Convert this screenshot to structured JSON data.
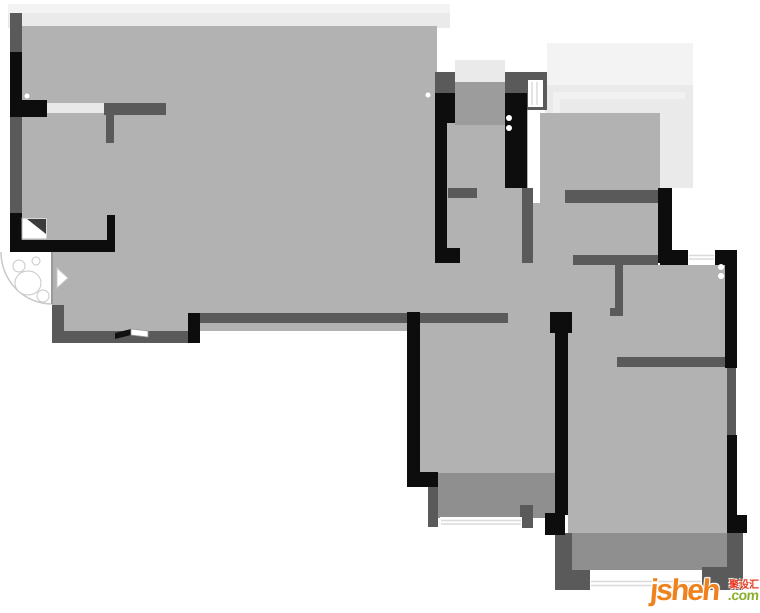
{
  "watermark": {
    "brand": "jsheh",
    "tld": ".com",
    "cn": "聚设汇",
    "brand_color": "#f0821e",
    "tld_color": "#8aaf2b",
    "cn_color": "#e8381d"
  },
  "floorplan": {
    "canvas": {
      "w": 760,
      "h": 613
    },
    "palette": {
      "room_floor": "#b2b2b2",
      "balcony_floor": "#8f8f8f",
      "entry_area": "#9c9c9c",
      "wall_gray": "#5a5a5a",
      "wall_black": "#0d0d0d",
      "glass_light": "#f3f3f3",
      "glass": "#eaeaea",
      "door_opening": "#e9e9e9",
      "window_white": "#ffffff"
    },
    "shapes": [
      {
        "t": "rect",
        "x": 8,
        "y": 4,
        "width": 442,
        "height": 9,
        "fill": "#f3f3f3",
        "name": "top-bay-window-outer"
      },
      {
        "t": "rect",
        "x": 8,
        "y": 13,
        "width": 442,
        "height": 15,
        "fill": "#eaeaea",
        "name": "top-bay-window-inner"
      },
      {
        "t": "rect",
        "x": 547,
        "y": 43,
        "width": 146,
        "height": 44,
        "fill": "#f3f3f3",
        "name": "right-balcony-outer"
      },
      {
        "t": "rect",
        "x": 545,
        "y": 85,
        "width": 148,
        "height": 103,
        "fill": "#eaeaea",
        "name": "right-balcony-glass"
      },
      {
        "t": "rect",
        "x": 553,
        "y": 92,
        "width": 132,
        "height": 90,
        "fill": "#f1f1f1",
        "name": "right-balcony-frame"
      },
      {
        "t": "rect",
        "x": 560,
        "y": 99,
        "width": 125,
        "height": 83,
        "fill": "#eaeaea",
        "name": "right-balcony-frame-2"
      },
      {
        "t": "rect",
        "x": 455,
        "y": 60,
        "width": 50,
        "height": 22,
        "fill": "#eaeaea",
        "name": "entry-porch-glass"
      },
      {
        "t": "rect",
        "x": 22,
        "y": 26,
        "width": 415,
        "height": 305,
        "fill": "#b2b2b2",
        "name": "living-room-floor"
      },
      {
        "t": "rect",
        "x": 437,
        "y": 93,
        "width": 91,
        "height": 220,
        "fill": "#b2b2b2",
        "name": "hallway-floor"
      },
      {
        "t": "rect",
        "x": 540,
        "y": 113,
        "width": 120,
        "height": 150,
        "fill": "#b2b2b2",
        "name": "kitchen-floor"
      },
      {
        "t": "rect",
        "x": 528,
        "y": 203,
        "width": 92,
        "height": 110,
        "fill": "#b2b2b2",
        "name": "corridor-floor"
      },
      {
        "t": "rect",
        "x": 568,
        "y": 265,
        "width": 159,
        "height": 95,
        "fill": "#b2b2b2",
        "name": "bedroom-2-floor"
      },
      {
        "t": "rect",
        "x": 420,
        "y": 313,
        "width": 135,
        "height": 162,
        "fill": "#b2b2b2",
        "name": "bedroom-1-floor"
      },
      {
        "t": "rect",
        "x": 568,
        "y": 360,
        "width": 159,
        "height": 173,
        "fill": "#b2b2b2",
        "name": "master-bedroom-floor"
      },
      {
        "t": "rect",
        "x": 438,
        "y": 473,
        "width": 117,
        "height": 45,
        "fill": "#8f8f8f",
        "name": "balcony-1-floor"
      },
      {
        "t": "rect",
        "x": 558,
        "y": 533,
        "width": 169,
        "height": 37,
        "fill": "#8f8f8f",
        "name": "balcony-2-floor"
      },
      {
        "t": "rect",
        "x": 0,
        "y": 252,
        "width": 52,
        "height": 91,
        "fill": "#ffffff",
        "name": "entry-recess"
      },
      {
        "t": "rect",
        "x": 455,
        "y": 82,
        "width": 50,
        "height": 43,
        "fill": "#9c9c9c",
        "name": "entry-door-area"
      },
      {
        "t": "rect",
        "x": 10,
        "y": 13,
        "width": 12,
        "height": 39,
        "fill": "#5a5a5a",
        "name": "wall-segment"
      },
      {
        "t": "rect",
        "x": 10,
        "y": 117,
        "width": 12,
        "height": 96,
        "fill": "#5a5a5a",
        "name": "wall-segment"
      },
      {
        "t": "rect",
        "x": 104,
        "y": 103,
        "width": 62,
        "height": 12,
        "fill": "#5a5a5a",
        "name": "wall-segment"
      },
      {
        "t": "rect",
        "x": 106,
        "y": 115,
        "width": 8,
        "height": 28,
        "fill": "#5a5a5a",
        "name": "wall-segment"
      },
      {
        "t": "rect",
        "x": 52,
        "y": 305,
        "width": 12,
        "height": 38,
        "fill": "#5a5a5a",
        "name": "wall-segment"
      },
      {
        "t": "rect",
        "x": 52,
        "y": 331,
        "width": 136,
        "height": 12,
        "fill": "#5a5a5a",
        "name": "wall-segment"
      },
      {
        "t": "rect",
        "x": 200,
        "y": 313,
        "width": 308,
        "height": 10,
        "fill": "#5a5a5a",
        "name": "wall-segment"
      },
      {
        "t": "rect",
        "x": 435,
        "y": 72,
        "width": 20,
        "height": 21,
        "fill": "#5a5a5a",
        "name": "wall-segment"
      },
      {
        "t": "rect",
        "x": 448,
        "y": 188,
        "width": 29,
        "height": 10,
        "fill": "#5a5a5a",
        "name": "wall-segment"
      },
      {
        "t": "rect",
        "x": 505,
        "y": 72,
        "width": 42,
        "height": 38,
        "fill": "#5a5a5a",
        "name": "wall-segment"
      },
      {
        "t": "rect",
        "x": 522,
        "y": 188,
        "width": 11,
        "height": 75,
        "fill": "#5a5a5a",
        "name": "wall-segment"
      },
      {
        "t": "rect",
        "x": 565,
        "y": 190,
        "width": 93,
        "height": 13,
        "fill": "#5a5a5a",
        "name": "wall-segment"
      },
      {
        "t": "rect",
        "x": 573,
        "y": 255,
        "width": 85,
        "height": 10,
        "fill": "#5a5a5a",
        "name": "wall-segment"
      },
      {
        "t": "rect",
        "x": 615,
        "y": 263,
        "width": 8,
        "height": 50,
        "fill": "#5a5a5a",
        "name": "wall-segment"
      },
      {
        "t": "rect",
        "x": 610,
        "y": 308,
        "width": 13,
        "height": 8,
        "fill": "#5a5a5a",
        "name": "wall-segment"
      },
      {
        "t": "rect",
        "x": 617,
        "y": 357,
        "width": 110,
        "height": 10,
        "fill": "#5a5a5a",
        "name": "wall-segment"
      },
      {
        "t": "rect",
        "x": 727,
        "y": 360,
        "width": 9,
        "height": 78,
        "fill": "#5a5a5a",
        "name": "wall-segment"
      },
      {
        "t": "rect",
        "x": 727,
        "y": 533,
        "width": 16,
        "height": 54,
        "fill": "#5a5a5a",
        "name": "wall-segment"
      },
      {
        "t": "rect",
        "x": 702,
        "y": 567,
        "width": 41,
        "height": 23,
        "fill": "#5a5a5a",
        "name": "wall-segment"
      },
      {
        "t": "rect",
        "x": 558,
        "y": 570,
        "width": 32,
        "height": 20,
        "fill": "#5a5a5a",
        "name": "wall-segment"
      },
      {
        "t": "rect",
        "x": 555,
        "y": 533,
        "width": 17,
        "height": 57,
        "fill": "#5a5a5a",
        "name": "wall-segment"
      },
      {
        "t": "rect",
        "x": 428,
        "y": 487,
        "width": 10,
        "height": 40,
        "fill": "#5a5a5a",
        "name": "wall-segment"
      },
      {
        "t": "rect",
        "x": 520,
        "y": 505,
        "width": 13,
        "height": 23,
        "fill": "#5a5a5a",
        "name": "wall-segment"
      },
      {
        "t": "rect",
        "x": 10,
        "y": 52,
        "width": 12,
        "height": 65,
        "fill": "#0d0d0d",
        "name": "wall-segment-black"
      },
      {
        "t": "rect",
        "x": 10,
        "y": 213,
        "width": 12,
        "height": 39,
        "fill": "#0d0d0d",
        "name": "wall-segment-black"
      },
      {
        "t": "rect",
        "x": 10,
        "y": 240,
        "width": 102,
        "height": 12,
        "fill": "#0d0d0d",
        "name": "wall-segment-black"
      },
      {
        "t": "rect",
        "x": 10,
        "y": 100,
        "width": 37,
        "height": 17,
        "fill": "#0d0d0d",
        "name": "wall-segment-black"
      },
      {
        "t": "rect",
        "x": 107,
        "y": 215,
        "width": 8,
        "height": 37,
        "fill": "#0d0d0d",
        "name": "wall-segment-black"
      },
      {
        "t": "rect",
        "x": 188,
        "y": 313,
        "width": 12,
        "height": 30,
        "fill": "#0d0d0d",
        "name": "wall-segment-black"
      },
      {
        "t": "rect",
        "x": 435,
        "y": 93,
        "width": 20,
        "height": 30,
        "fill": "#0d0d0d",
        "name": "wall-segment-black"
      },
      {
        "t": "rect",
        "x": 435,
        "y": 123,
        "width": 12,
        "height": 140,
        "fill": "#0d0d0d",
        "name": "wall-segment-black"
      },
      {
        "t": "rect",
        "x": 435,
        "y": 248,
        "width": 25,
        "height": 15,
        "fill": "#0d0d0d",
        "name": "wall-segment-black"
      },
      {
        "t": "rect",
        "x": 505,
        "y": 93,
        "width": 22,
        "height": 95,
        "fill": "#0d0d0d",
        "name": "wall-segment-black"
      },
      {
        "t": "rect",
        "x": 658,
        "y": 188,
        "width": 14,
        "height": 75,
        "fill": "#0d0d0d",
        "name": "wall-segment-black"
      },
      {
        "t": "rect",
        "x": 660,
        "y": 250,
        "width": 28,
        "height": 15,
        "fill": "#0d0d0d",
        "name": "wall-segment-black"
      },
      {
        "t": "rect",
        "x": 715,
        "y": 250,
        "width": 22,
        "height": 15,
        "fill": "#0d0d0d",
        "name": "wall-segment-black"
      },
      {
        "t": "rect",
        "x": 725,
        "y": 250,
        "width": 12,
        "height": 118,
        "fill": "#0d0d0d",
        "name": "wall-segment-black"
      },
      {
        "t": "rect",
        "x": 727,
        "y": 435,
        "width": 10,
        "height": 98,
        "fill": "#0d0d0d",
        "name": "wall-segment-black"
      },
      {
        "t": "rect",
        "x": 737,
        "y": 515,
        "width": 10,
        "height": 18,
        "fill": "#0d0d0d",
        "name": "wall-segment-black"
      },
      {
        "t": "rect",
        "x": 407,
        "y": 312,
        "width": 13,
        "height": 160,
        "fill": "#0d0d0d",
        "name": "wall-segment-black"
      },
      {
        "t": "rect",
        "x": 407,
        "y": 472,
        "width": 31,
        "height": 15,
        "fill": "#0d0d0d",
        "name": "wall-segment-black"
      },
      {
        "t": "rect",
        "x": 550,
        "y": 312,
        "width": 22,
        "height": 21,
        "fill": "#0d0d0d",
        "name": "wall-segment-black"
      },
      {
        "t": "rect",
        "x": 555,
        "y": 333,
        "width": 13,
        "height": 182,
        "fill": "#0d0d0d",
        "name": "wall-segment-black"
      },
      {
        "t": "rect",
        "x": 545,
        "y": 513,
        "width": 20,
        "height": 22,
        "fill": "#0d0d0d",
        "name": "wall-segment-black"
      },
      {
        "t": "rect",
        "x": 47,
        "y": 103,
        "width": 57,
        "height": 10,
        "fill": "#e9e9e9",
        "name": "door-opening"
      },
      {
        "t": "rect",
        "x": 528,
        "y": 80,
        "width": 15,
        "height": 27,
        "fill": "#ffffff",
        "name": "window"
      },
      {
        "t": "line",
        "x1": 532,
        "y1": 82,
        "x2": 532,
        "y2": 105,
        "stroke": "#dadada",
        "stroke-width": 1.5,
        "name": "window-mullion"
      },
      {
        "t": "line",
        "x1": 537,
        "y1": 82,
        "x2": 537,
        "y2": 105,
        "stroke": "#dadada",
        "stroke-width": 1.5,
        "name": "window-mullion"
      },
      {
        "t": "rect",
        "x": 688,
        "y": 252,
        "width": 27,
        "height": 11,
        "fill": "#ffffff",
        "name": "window"
      },
      {
        "t": "line",
        "x1": 689,
        "y1": 255.5,
        "x2": 714,
        "y2": 255.5,
        "stroke": "#dadada",
        "stroke-width": 1.5,
        "name": "window-mullion"
      },
      {
        "t": "line",
        "x1": 689,
        "y1": 259,
        "x2": 714,
        "y2": 259,
        "stroke": "#dadada",
        "stroke-width": 1.5,
        "name": "window-mullion"
      },
      {
        "t": "rect",
        "x": 440,
        "y": 517,
        "width": 82,
        "height": 11,
        "fill": "#ffffff",
        "name": "window"
      },
      {
        "t": "line",
        "x1": 441,
        "y1": 520.5,
        "x2": 521,
        "y2": 520.5,
        "stroke": "#dadada",
        "stroke-width": 1.5,
        "name": "window-mullion"
      },
      {
        "t": "line",
        "x1": 441,
        "y1": 524,
        "x2": 521,
        "y2": 524,
        "stroke": "#dadada",
        "stroke-width": 1.5,
        "name": "window-mullion"
      },
      {
        "t": "rect",
        "x": 590,
        "y": 578,
        "width": 112,
        "height": 12,
        "fill": "#ffffff",
        "name": "window"
      },
      {
        "t": "line",
        "x1": 591,
        "y1": 581.5,
        "x2": 701,
        "y2": 581.5,
        "stroke": "#dadada",
        "stroke-width": 1.5,
        "name": "window-mullion"
      },
      {
        "t": "line",
        "x1": 591,
        "y1": 585.5,
        "x2": 701,
        "y2": 585.5,
        "stroke": "#dadada",
        "stroke-width": 1.5,
        "name": "window-mullion"
      },
      {
        "t": "rect",
        "x": 22,
        "y": 218,
        "width": 25,
        "height": 21,
        "fill": "#ffffff",
        "stroke": "#b0b0b0",
        "stroke-width": 1,
        "name": "corner-shelf"
      },
      {
        "t": "polygon",
        "points": "27,219 46,219 46,234",
        "fill": "#3c3c3c",
        "name": "corner-shelf-shade"
      },
      {
        "t": "polygon",
        "points": "115,333 131,329 131,335 115,339",
        "fill": "#111111",
        "name": "window-slat-dark"
      },
      {
        "t": "polygon",
        "points": "131,329 148,331 148,337 131,335",
        "fill": "#ffffff",
        "stroke": "#9a9a9a",
        "stroke-width": 0.8,
        "name": "window-slat-light"
      },
      {
        "t": "path",
        "d": "M 1 252 A 51 52 0 0 0 52 304",
        "fill": "none",
        "stroke": "#c9c9c9",
        "stroke-width": 1.5,
        "name": "entry-door-swing-arc"
      },
      {
        "t": "line",
        "x1": 52,
        "y1": 252,
        "x2": 52,
        "y2": 304,
        "stroke": "#9a9a9a",
        "stroke-width": 2,
        "name": "entry-door-leaf"
      },
      {
        "t": "ellipse",
        "cx": 28,
        "cy": 283,
        "rx": 13,
        "ry": 12,
        "fill": "#ffffff",
        "stroke": "#c8c8c8",
        "stroke-width": 1,
        "name": "entry-decor-sketch"
      },
      {
        "t": "circle",
        "cx": 19,
        "cy": 266,
        "r": 6,
        "fill": "#ffffff",
        "stroke": "#c8c8c8",
        "stroke-width": 1,
        "name": "entry-decor-sketch"
      },
      {
        "t": "circle",
        "cx": 43,
        "cy": 296,
        "r": 6,
        "fill": "#ffffff",
        "stroke": "#c8c8c8",
        "stroke-width": 1,
        "name": "entry-decor-sketch"
      },
      {
        "t": "circle",
        "cx": 36,
        "cy": 261,
        "r": 4,
        "fill": "#ffffff",
        "stroke": "#c8c8c8",
        "stroke-width": 1,
        "name": "entry-decor-sketch"
      },
      {
        "t": "polygon",
        "points": "57,268 68,278 57,288",
        "fill": "#ffffff",
        "stroke": "#c8c8c8",
        "stroke-width": 1,
        "name": "entry-decor-sketch"
      },
      {
        "t": "circle",
        "cx": 27,
        "cy": 96,
        "r": 2.5,
        "fill": "#ffffff",
        "name": "hinge-dot"
      },
      {
        "t": "circle",
        "cx": 428,
        "cy": 95,
        "r": 2.5,
        "fill": "#ffffff",
        "name": "hinge-dot"
      },
      {
        "t": "circle",
        "cx": 509,
        "cy": 118,
        "r": 3,
        "fill": "#ffffff",
        "name": "hinge-dot"
      },
      {
        "t": "circle",
        "cx": 509,
        "cy": 128,
        "r": 3,
        "fill": "#ffffff",
        "name": "hinge-dot"
      },
      {
        "t": "circle",
        "cx": 721,
        "cy": 267,
        "r": 3,
        "fill": "#ffffff",
        "name": "hinge-dot"
      },
      {
        "t": "circle",
        "cx": 721,
        "cy": 276,
        "r": 3,
        "fill": "#ffffff",
        "name": "hinge-dot"
      }
    ]
  }
}
